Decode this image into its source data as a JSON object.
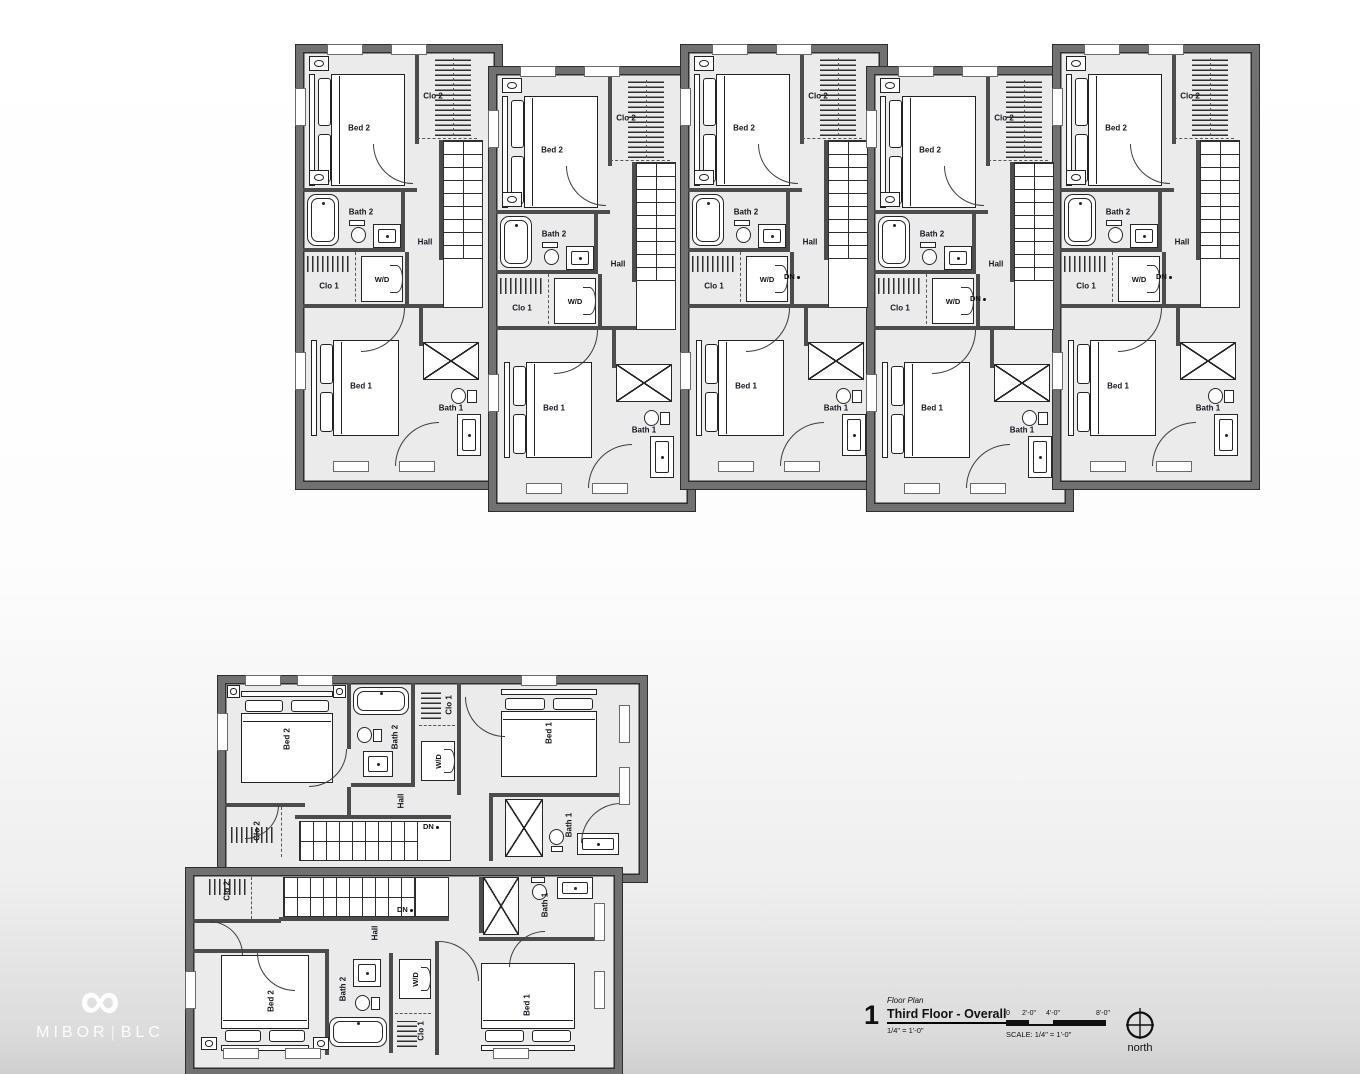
{
  "watermark": {
    "logo_glyph": "∞",
    "text_left": "MIBOR",
    "divider": "|",
    "text_right": "BLC"
  },
  "title_block": {
    "sheet_number": "1",
    "category_label": "Floor Plan",
    "title": "Third Floor - Overall",
    "scale_note": "1/4\" = 1'-0\"",
    "scale_caption": "SCALE: 1/4\" = 1'-0\"",
    "scale_ticks": [
      "0",
      "2'-0\"",
      "4'-0\"",
      "8'-0\""
    ],
    "north_label": "north"
  },
  "units": [
    {
      "id": "unit-1",
      "orientation": "vertical",
      "rooms": {
        "bed2": "Bed 2",
        "clo2": "Clo 2",
        "bath2": "Bath 2",
        "hall": "Hall",
        "clo1": "Clo 1",
        "wd": "W/D",
        "bed1": "Bed 1",
        "bath1": "Bath 1"
      }
    },
    {
      "id": "unit-2",
      "orientation": "vertical",
      "rooms": {
        "bed2": "Bed 2",
        "clo2": "Clo 2",
        "bath2": "Bath 2",
        "hall": "Hall",
        "clo1": "Clo 1",
        "wd": "W/D",
        "bed1": "Bed 1",
        "bath1": "Bath 1"
      }
    },
    {
      "id": "unit-3",
      "orientation": "vertical",
      "rooms": {
        "bed2": "Bed 2",
        "clo2": "Clo 2",
        "bath2": "Bath 2",
        "hall": "Hall",
        "clo1": "Clo 1",
        "wd": "W/D",
        "bed1": "Bed 1",
        "bath1": "Bath 1",
        "dn": "DN"
      }
    },
    {
      "id": "unit-4",
      "orientation": "vertical",
      "rooms": {
        "bed2": "Bed 2",
        "clo2": "Clo 2",
        "bath2": "Bath 2",
        "hall": "Hall",
        "clo1": "Clo 1",
        "wd": "W/D",
        "bed1": "Bed 1",
        "bath1": "Bath 1",
        "dn": "DN"
      }
    },
    {
      "id": "unit-5",
      "orientation": "vertical",
      "rooms": {
        "bed2": "Bed 2",
        "clo2": "Clo 2",
        "bath2": "Bath 2",
        "hall": "Hall",
        "clo1": "Clo 1",
        "wd": "W/D",
        "bed1": "Bed 1",
        "bath1": "Bath 1",
        "dn": "DN"
      }
    },
    {
      "id": "unit-6",
      "orientation": "horizontal-up",
      "rooms": {
        "bed2": "Bed 2",
        "clo2": "Clo 2",
        "bath2": "Bath 2",
        "hall": "Hall",
        "clo1": "Clo 1",
        "wd": "W/D",
        "bed1": "Bed 1",
        "bath1": "Bath 1",
        "dn": "DN"
      }
    },
    {
      "id": "unit-7",
      "orientation": "horizontal-down",
      "rooms": {
        "bed2": "Bed 2",
        "clo2": "Clo 2",
        "bath2": "Bath 2",
        "hall": "Hall",
        "clo1": "Clo 1",
        "wd": "W/D",
        "bed1": "Bed 1",
        "bath1": "Bath 1",
        "dn": "DN"
      }
    }
  ]
}
